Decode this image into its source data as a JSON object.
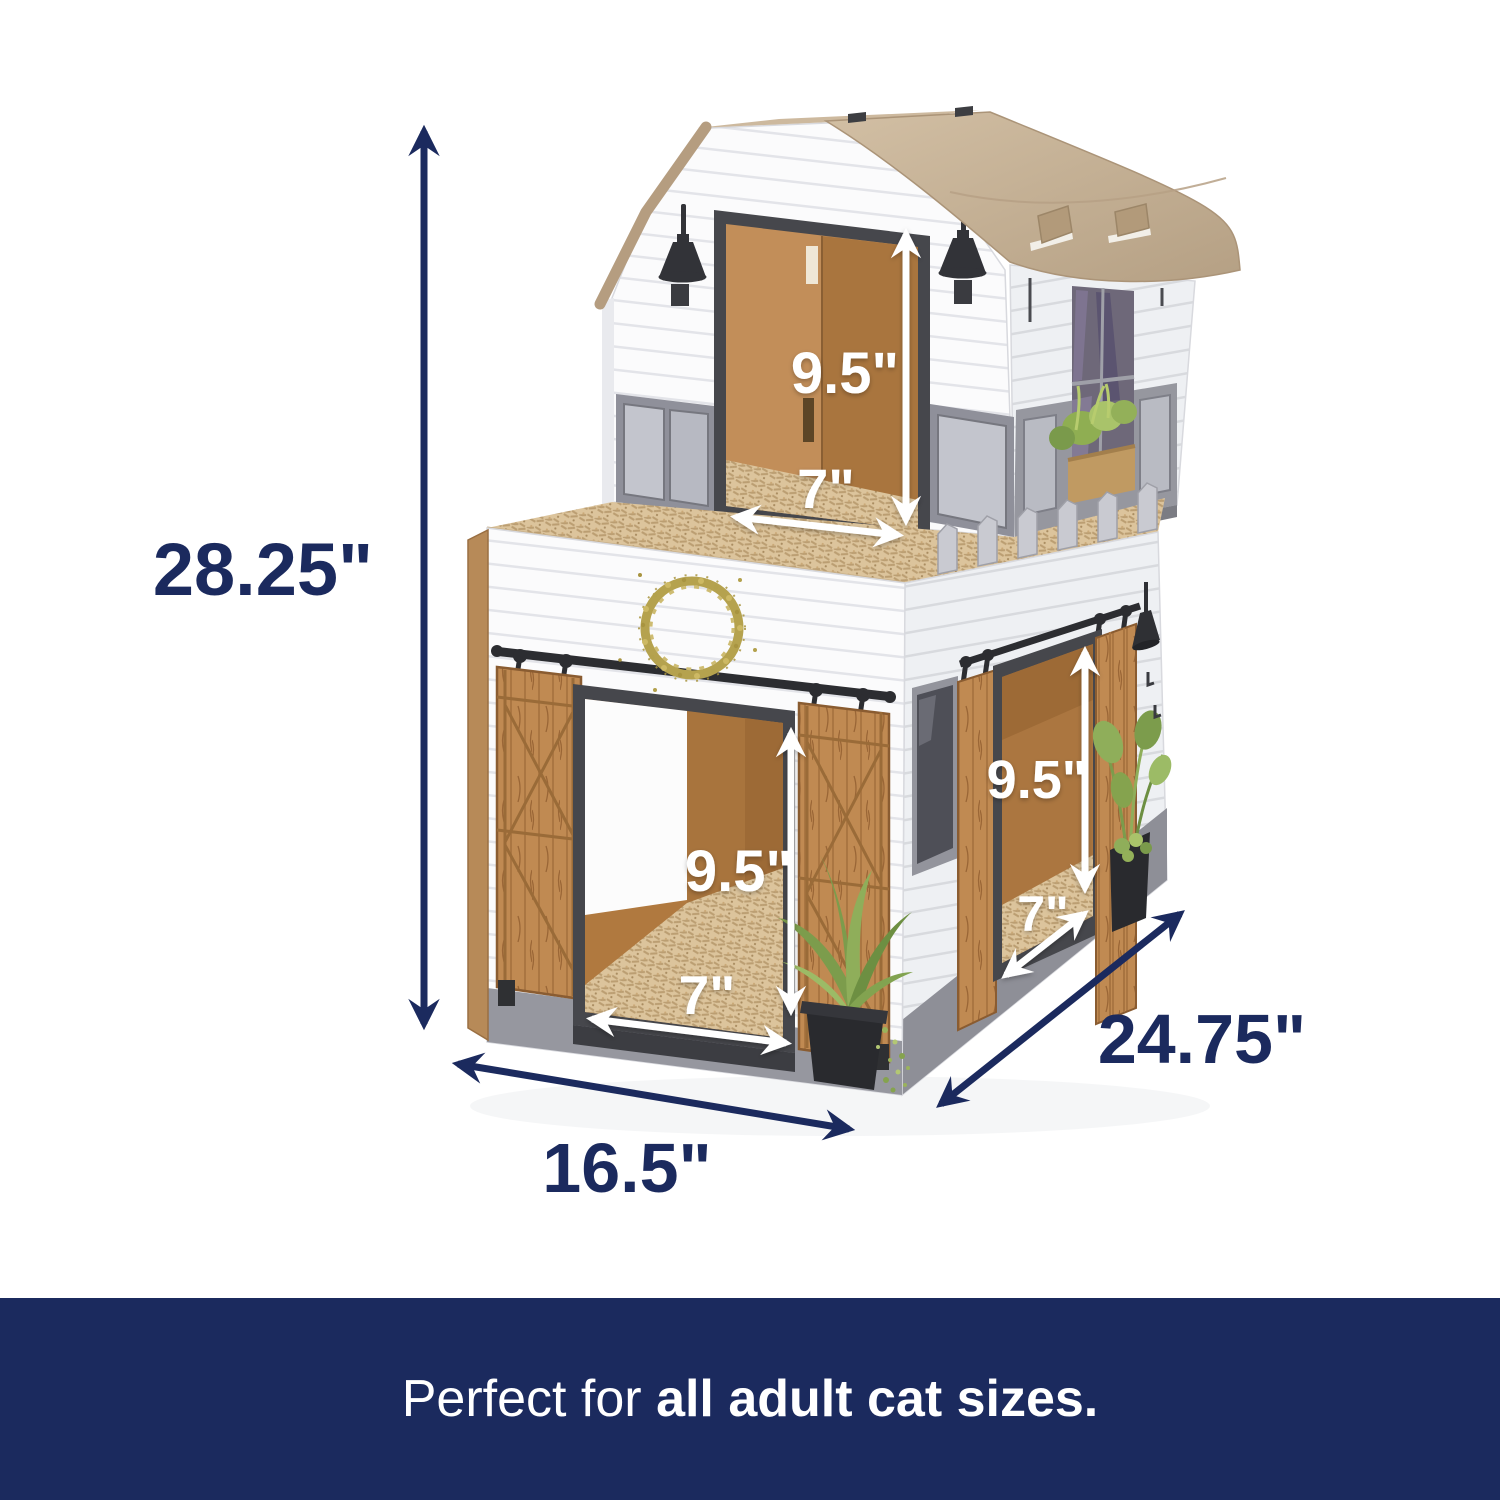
{
  "banner": {
    "prefix": "Perfect for ",
    "emphasis": "all adult cat sizes."
  },
  "dimensions": {
    "overall_height": "28.25\"",
    "base_width": "16.5\"",
    "base_depth": "24.75\"",
    "loft_door": {
      "height": "9.5\"",
      "width": "7\""
    },
    "front_door": {
      "height": "9.5\"",
      "width": "7\""
    },
    "side_door": {
      "height": "9.5\"",
      "width": "7\""
    }
  },
  "colors": {
    "navy": "#1b2a5e",
    "wall_white": "#fbfbfc",
    "roof_tan": "#c4ae92",
    "cardboard": "#b0793f",
    "wood": "#c08a52",
    "scratcher": "#dcc49c",
    "trim_gray": "#96979f",
    "frame_dark": "#46474c",
    "label_white": "#ffffff"
  }
}
